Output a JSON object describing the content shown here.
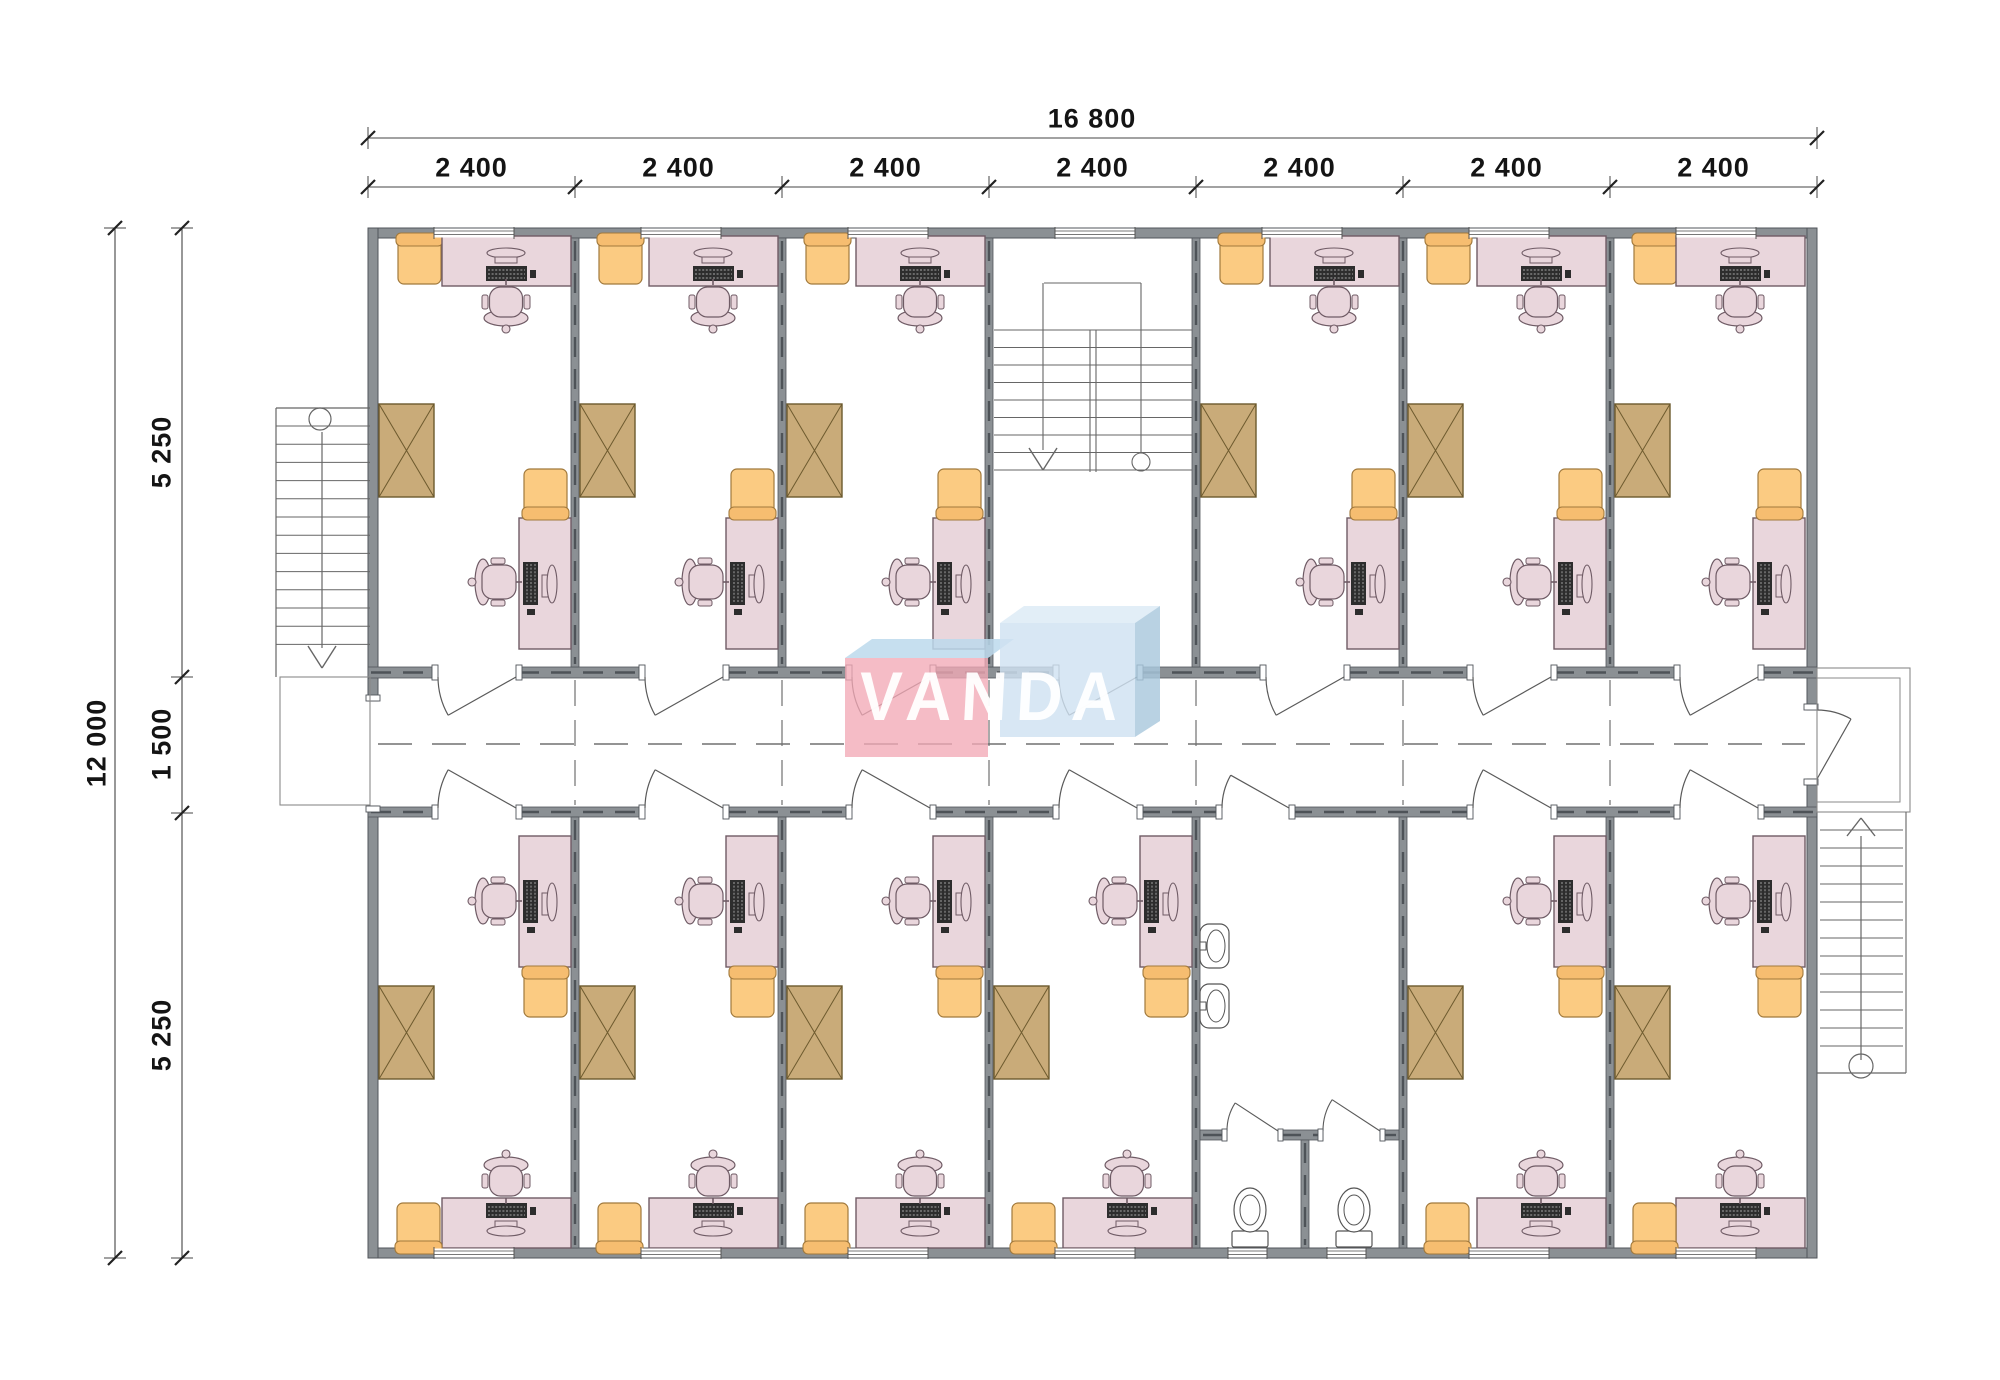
{
  "page": {
    "type": "architectural floor plan drawing",
    "background": "#ffffff"
  },
  "watermark": {
    "text": "VANDA",
    "colors": {
      "pink_front": "#f2a9b6",
      "pink_top": "#bcd9ec",
      "blue_front": "#cfe2f1",
      "blue_top": "#ddebf6",
      "blue_side": "#a9c8dd"
    }
  },
  "dimensions": {
    "top_total": "16 800",
    "top_segments": [
      "2 400",
      "2 400",
      "2 400",
      "2 400",
      "2 400",
      "2 400",
      "2 400"
    ],
    "left_total": "12 000",
    "left_segments": [
      "5 250",
      "1 500",
      "5 250"
    ]
  },
  "rooms": {
    "top_row": [
      "office",
      "office",
      "office",
      "stairwell",
      "office",
      "office",
      "office"
    ],
    "bottom_row": [
      "office",
      "office",
      "office",
      "office",
      "bathroom",
      "office",
      "office"
    ],
    "office_furniture": [
      "armchair",
      "desk with computer",
      "office chair",
      "cabinet",
      "desk with computer",
      "office chair",
      "armchair"
    ],
    "bathroom_fixtures": [
      "wash basin",
      "wash basin",
      "toilet stall",
      "toilet stall"
    ],
    "circulation": [
      "left exterior stair",
      "central stairwell",
      "right exterior stair",
      "corridor"
    ]
  },
  "colors": {
    "wall": "#8b9094",
    "wall_edge": "#51565b",
    "wall_dash": "#4e5358",
    "desk": "#e9d6dc",
    "desk_edge": "#6f5b65",
    "armchair": "#fbcb82",
    "armchair_back": "#f6bd70",
    "armchair_edge": "#a1793c",
    "cabinet": "#c9ab79",
    "cabinet_edge": "#6d5a2e",
    "computer_dark": "#2d2d2d",
    "computer_stripe": "#cfcfcf",
    "fixture": "#ffffff",
    "fixture_edge": "#555555",
    "stair_line": "#666666",
    "landing_line": "#8a8a8a",
    "door_line": "#5a5a5a",
    "dashed_line": "#707070",
    "window_line": "#777777",
    "dim_line": "#444444",
    "dim_tick": "#222222",
    "dim_text": "#141414"
  }
}
